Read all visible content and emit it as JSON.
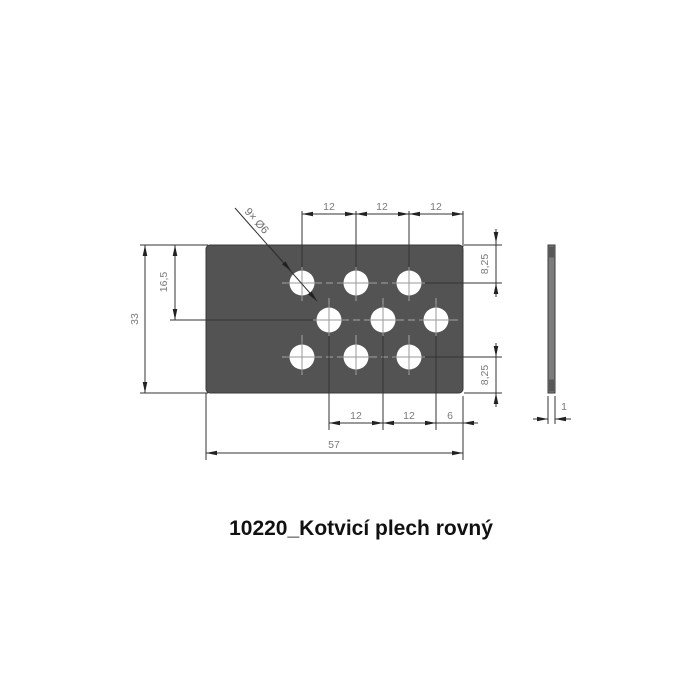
{
  "title": "10220_Kotvicí plech rovný",
  "dims": {
    "top": [
      "12",
      "12",
      "12"
    ],
    "bottom": [
      "12",
      "12",
      "6"
    ],
    "total_width": "57",
    "total_height": "33",
    "mid_height": "16,5",
    "right_top": "8,25",
    "right_bottom": "8,25",
    "thickness": "1",
    "holes_note": "9× Ø6"
  },
  "part": {
    "plate_width_mm": 57,
    "plate_height_mm": 33,
    "thickness_mm": 1,
    "hole_count": 9,
    "hole_diameter_mm": 6,
    "hole_pitch_mm": 12,
    "row_spacing_mm": 8.25,
    "mid_row_depth_mm": 16.5,
    "edge_offset_mm": 6
  },
  "colors": {
    "plate": "#535353",
    "side_view": "#7c7c7c",
    "dimension_line": "#333333",
    "centerline": "#a6a6a6",
    "dim_text": "#7a7a7a",
    "title_text": "#111111",
    "background": "#ffffff"
  }
}
